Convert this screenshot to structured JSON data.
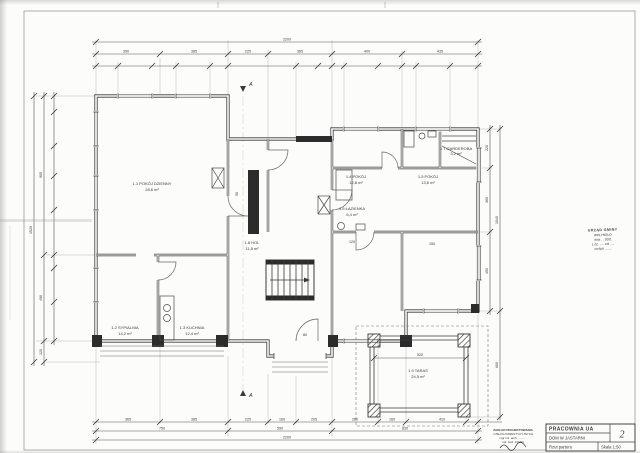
{
  "title_block": {
    "studio": "PRACOWNIA UA",
    "project": "DOM W JASTARNI",
    "drawing_title": "Rzut parteru",
    "scale": "Skala 1:50",
    "sheet_number": "2"
  },
  "office_stamp": {
    "lines": [
      "URZĄD GMINY",
      "WPŁYNĘŁO",
      "dnia . . 2001",
      "L.dz. ..... zał. ....",
      "podpis ........"
    ]
  },
  "architect_stamp": {
    "lines": [
      "ZAKŁAD PROJEKTOWANIA",
      "i USŁUG INWESTYCYJNYCH",
      "mgr inż. arch. ..........",
      "upr. bud. 123/94"
    ]
  },
  "section_marker": "A",
  "rooms": [
    {
      "name": "1.1 POKÓJ DZIENNY",
      "area": "28,6 m²"
    },
    {
      "name": "1.2 SYPIALNIA",
      "area": "14,2 m²"
    },
    {
      "name": "1.3 KUCHNIA",
      "area": "12,4 m²"
    },
    {
      "name": "1.4 POKÓJ",
      "area": "12,8 m²"
    },
    {
      "name": "1.5 POKÓJ",
      "area": "13,6 m²"
    },
    {
      "name": "1.6 ŁAZIENKA",
      "area": "6,4 m²"
    },
    {
      "name": "1.7 GARDEROBA",
      "area": "3,2 m²"
    },
    {
      "name": "1.8 HOL",
      "area": "11,8 m²"
    },
    {
      "name": "1.9 TARAS",
      "area": "24,5 m²"
    }
  ],
  "dimensions": {
    "top_total": "2200",
    "top_row": [
      "390",
      "385",
      "225",
      "365",
      "400",
      "435"
    ],
    "bottom_row": [
      "365",
      "385",
      "225",
      "160",
      "205",
      "260",
      "160",
      "410"
    ],
    "bottom_mid": [
      "750",
      "590",
      "830"
    ],
    "bottom_total": "2200",
    "left_col": [
      "905",
      "490",
      "120"
    ],
    "left_total": "1520",
    "right_col": [
      "220",
      "365",
      "450",
      "600"
    ],
    "right_total": "1040",
    "terrace_width": "520",
    "inner": [
      "90",
      "80",
      "120",
      "150"
    ]
  }
}
